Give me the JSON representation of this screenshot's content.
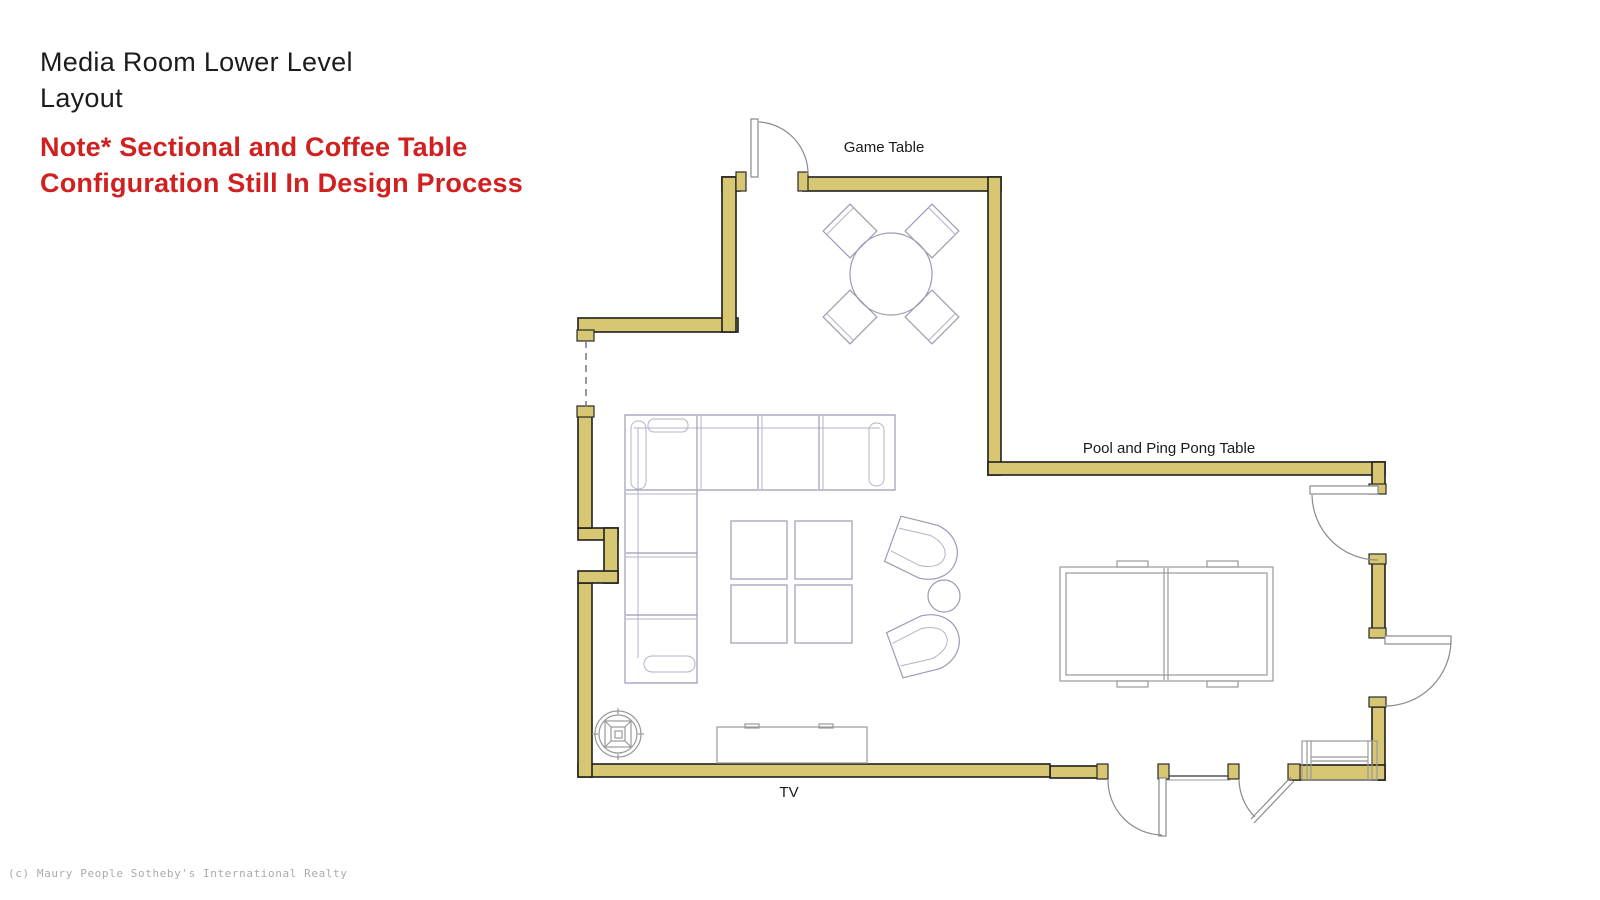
{
  "page": {
    "title_line1": "Media Room Lower Level",
    "title_line2": "Layout",
    "note_line1": "Note* Sectional and Coffee Table",
    "note_line2": "Configuration Still In Design Process",
    "copyright": "(c) Maury People Sotheby's International Realty"
  },
  "plan": {
    "labels": {
      "game_table": "Game Table",
      "pool_ping_pong": "Pool and Ping Pong Table",
      "tv": "TV"
    },
    "colors": {
      "wall_fill": "#d8c772",
      "wall_outline": "#1f1f1f",
      "furniture_outline": "#9b9bb4",
      "door_outline": "#8a8a8a",
      "note_red": "#d02020",
      "copyright_gray": "#ababab"
    }
  }
}
